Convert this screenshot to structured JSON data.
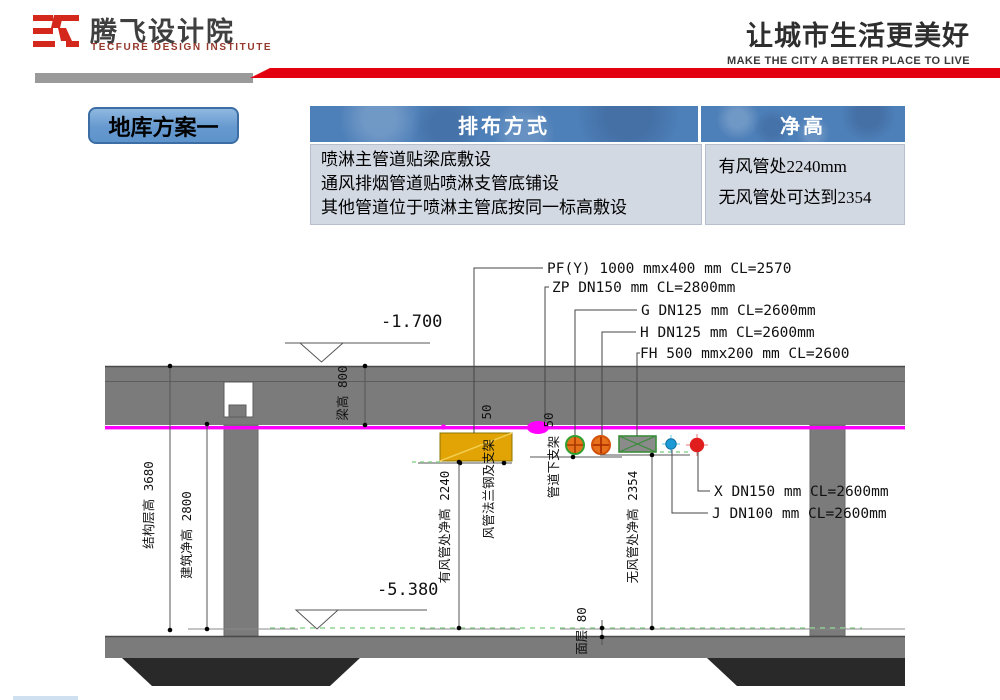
{
  "header": {
    "logo_cn": "腾飞设计院",
    "logo_en": "TECFURE DESIGN INSTITUTE",
    "slogan_cn": "让城市生活更美好",
    "slogan_en": "MAKE THE CITY A BETTER PLACE TO LIVE"
  },
  "plan_label": "地库方案一",
  "table": {
    "headers": [
      "排布方式",
      "净高"
    ],
    "arrangement_lines": [
      "喷淋主管道贴梁底敷设",
      "通风排烟管道贴喷淋支管底铺设",
      "其他管道位于喷淋主管底按同一标高敷设"
    ],
    "clearance_lines": [
      "有风管处2240mm",
      "无风管处可达到2354"
    ]
  },
  "drawing": {
    "pipe_labels": {
      "pf": "PF(Y) 1000 mmx400 mm CL=2570",
      "zp": "ZP DN150 mm CL=2800mm",
      "g": "G DN125 mm CL=2600mm",
      "h": "H DN125 mm CL=2600mm",
      "fh": "FH 500 mmx200 mm  CL=2600",
      "x": "X DN150 mm CL=2600mm",
      "j": "J DN100 mm CL=2600mm"
    },
    "elevations": {
      "upper": "-1.700",
      "lower": "-5.380"
    },
    "dimensions": {
      "structure_height": "结构层高 3680",
      "building_clear": "建筑净高 2800",
      "beam_height": "梁高 800",
      "duct_zone_clear": "有风管处净高 2240",
      "no_duct_clear": "无风管处净高 2354",
      "finish_layer": "面层 80",
      "flange_support": "风管法兰钢及支架",
      "flange_support_dim": "50",
      "pipe_support": "管道下支架",
      "pipe_support_dim": "50"
    },
    "colors": {
      "brand_red": "#E3000F",
      "sprinkler_magenta": "#FF00FF",
      "exhaust_duct_yellow": "#E2A404",
      "fh_duct_green": "#3B8C3B",
      "pipe_orange": "#E7711B",
      "hydrant_red": "#E01E1E",
      "water_blue": "#1C9AD6",
      "structure_gray": "#7B7B7B",
      "footing_dark": "#292929",
      "table_header_blue": "#4D7FB8",
      "table_body_blue": "#D3D9E3"
    }
  }
}
